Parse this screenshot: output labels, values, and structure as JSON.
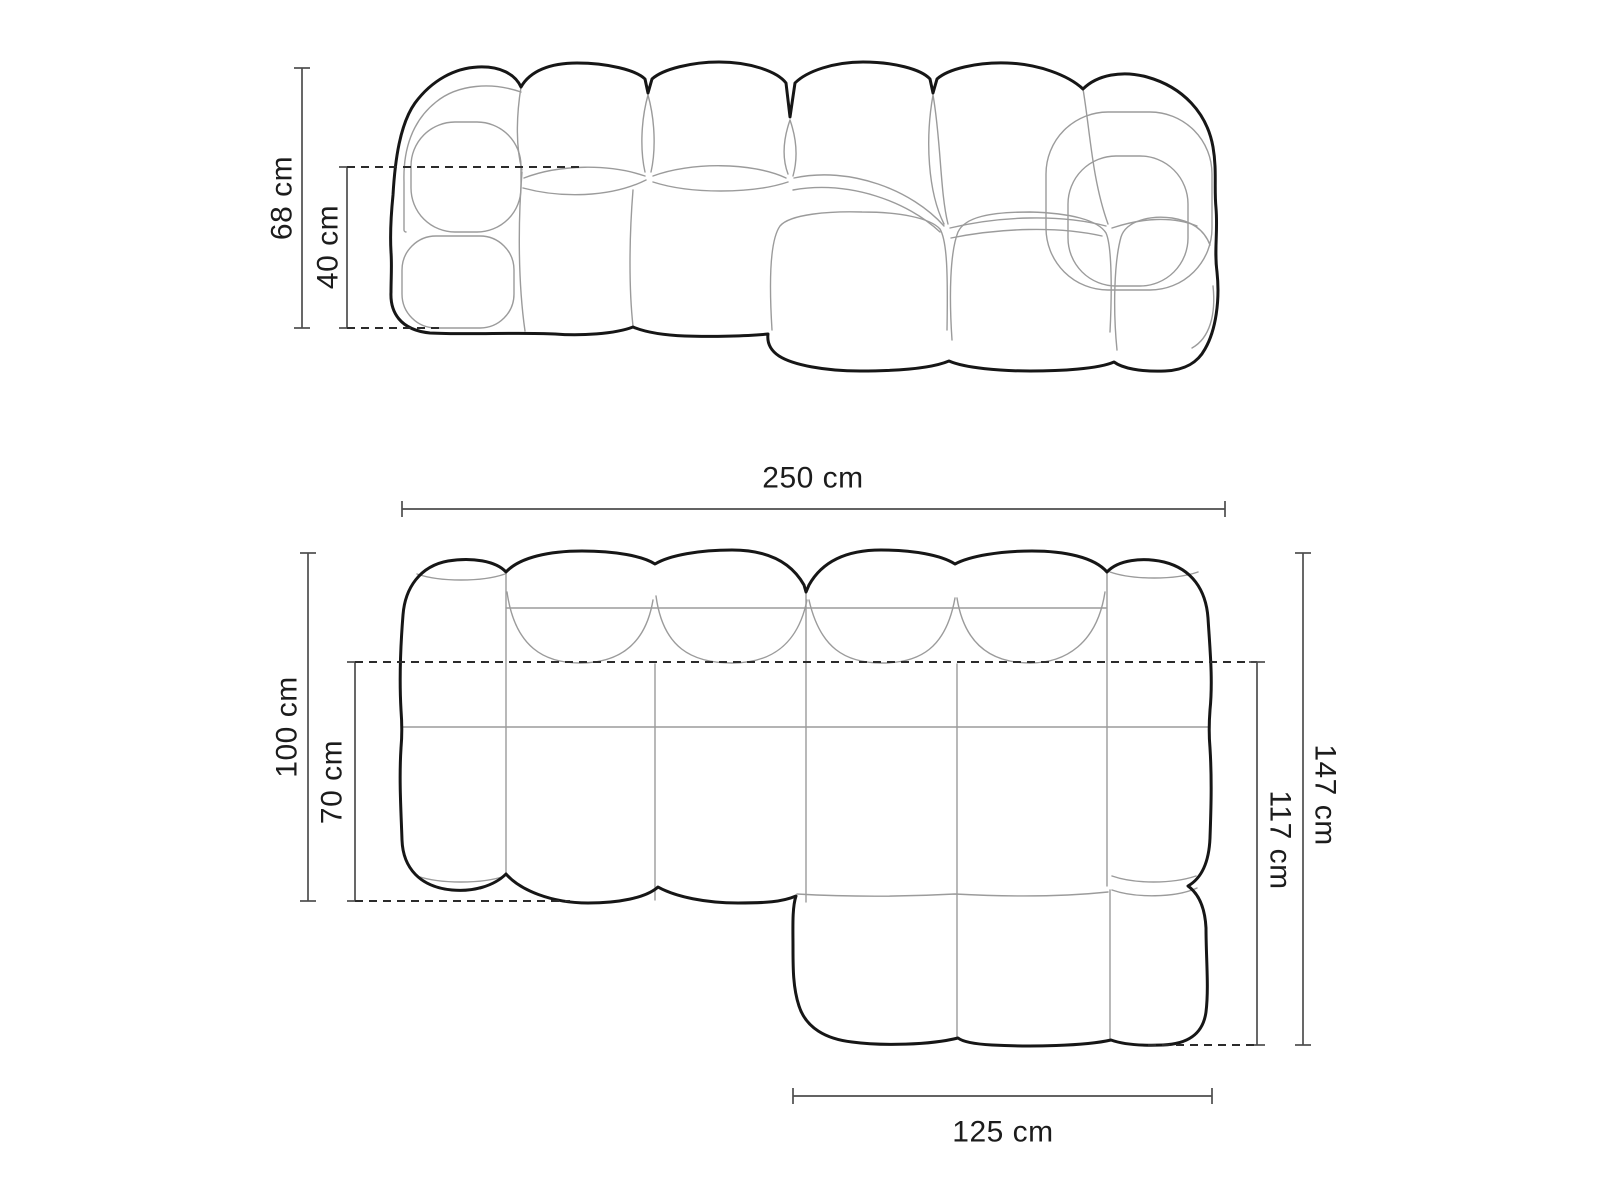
{
  "diagram": {
    "subject": "modular chaise sofa dimension drawing",
    "views": {
      "front_view_name": "front elevation",
      "top_view_name": "top plan view"
    },
    "front_view": {
      "overall_height": {
        "value": 68,
        "unit": "cm",
        "label": "68 cm"
      },
      "seat_height": {
        "value": 40,
        "unit": "cm",
        "label": "40 cm"
      }
    },
    "top_view": {
      "overall_width": {
        "value": 250,
        "unit": "cm",
        "label": "250 cm"
      },
      "body_depth": {
        "value": 100,
        "unit": "cm",
        "label": "100 cm"
      },
      "seat_depth": {
        "value": 70,
        "unit": "cm",
        "label": "70 cm"
      },
      "total_depth": {
        "value": 147,
        "unit": "cm",
        "label": "147 cm"
      },
      "chaise_depth": {
        "value": 117,
        "unit": "cm",
        "label": "117 cm"
      },
      "chaise_width": {
        "value": 125,
        "unit": "cm",
        "label": "125 cm"
      }
    },
    "colors": {
      "background": "#ffffff",
      "outline": "#161616",
      "seam": "#9b9b9b",
      "dimension_line": "#4d4d4d",
      "dashed_line": "#2b2b2b",
      "text": "#1c1c1c"
    }
  }
}
